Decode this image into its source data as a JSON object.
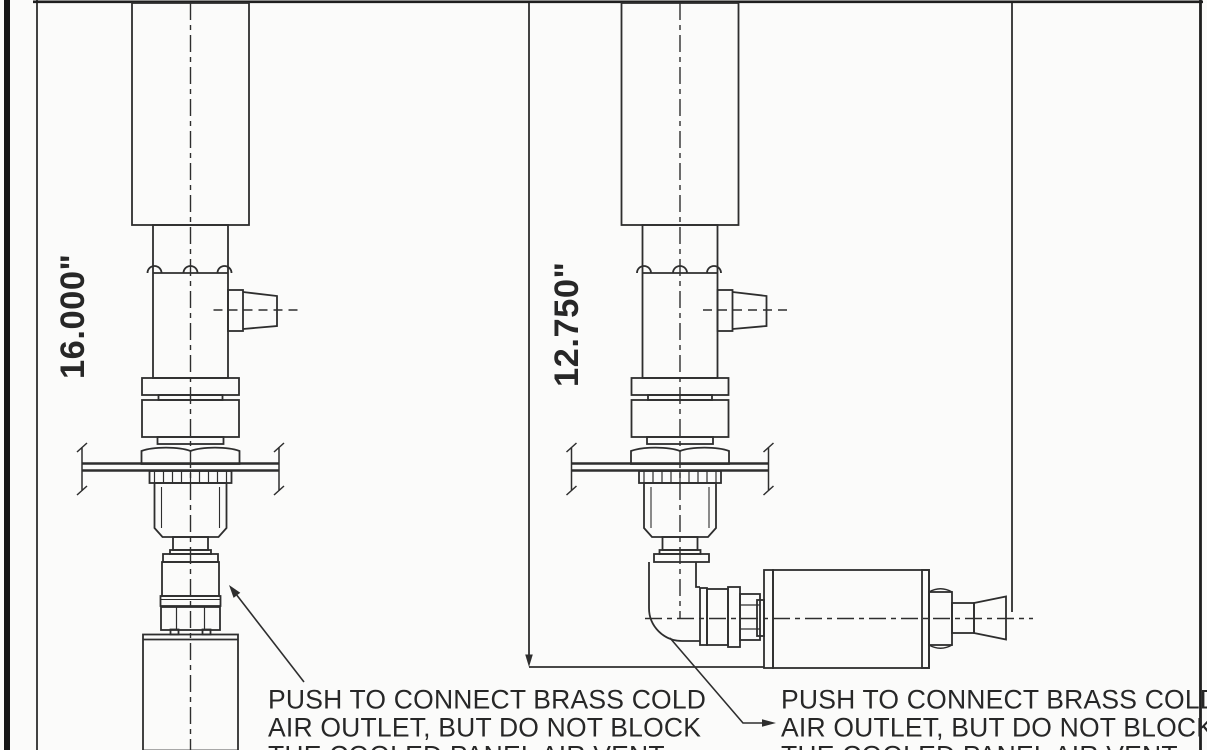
{
  "page": {
    "background_color": "#fbfbfa",
    "line_color": "#2e2e2e",
    "border_bar_color": "#161616",
    "text_color": "#272727"
  },
  "drawing": {
    "left_assembly": {
      "dimension_label": "16.000\"",
      "note": {
        "line1": "PUSH TO CONNECT BRASS COLD",
        "line2": "AIR OUTLET, BUT DO NOT BLOCK",
        "line3_partially_cut_off": "THE COOLED PANEL AIR VENT"
      }
    },
    "right_assembly": {
      "dimension_label": "12.750\"",
      "note": {
        "line1": "PUSH TO CONNECT BRASS COLD",
        "line2": "AIR OUTLET, BUT DO NOT BLOCK",
        "line3_partially_cut_off": "THE COOLED PANEL AIR VENT"
      }
    }
  }
}
